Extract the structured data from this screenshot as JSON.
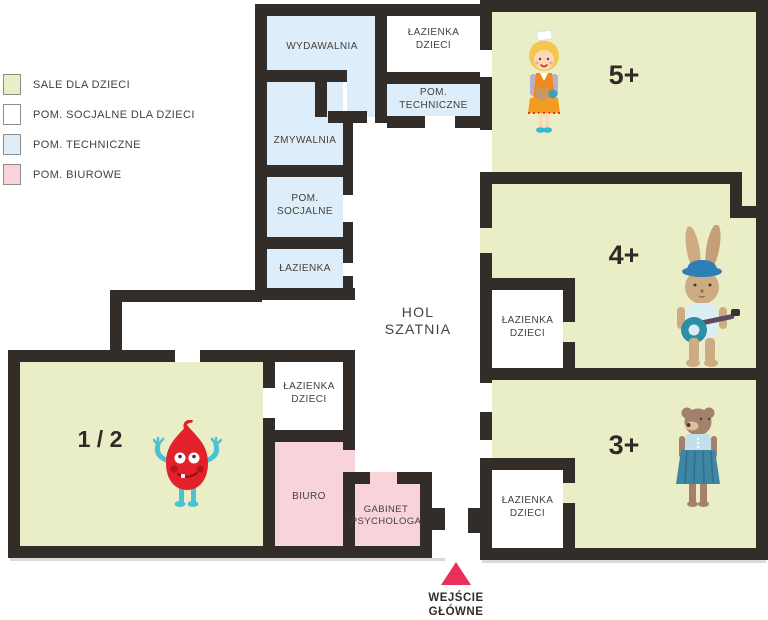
{
  "legend": {
    "items": [
      {
        "label": "SALE DLA DZIECI",
        "color": "#eaeec6"
      },
      {
        "label": "POM. SOCJALNE DLA DZIECI",
        "color": "#ffffff"
      },
      {
        "label": "POM. TECHNICZNE",
        "color": "#ddeefa"
      },
      {
        "label": "POM. BIUROWE",
        "color": "#f8d4da"
      }
    ]
  },
  "rooms": {
    "wydawalnia": {
      "label": "WYDAWALNIA",
      "type": "techniczne"
    },
    "lazienka_dzieci_top": {
      "line1": "ŁAZIENKA",
      "line2": "DZIECI",
      "type": "socjalne"
    },
    "pom_techniczne": {
      "line1": "POM.",
      "line2": "TECHNICZNE",
      "type": "techniczne"
    },
    "zmywalnia": {
      "label": "ZMYWALNIA",
      "type": "techniczne"
    },
    "pom_socjalne": {
      "line1": "POM.",
      "line2": "SOCJALNE",
      "type": "techniczne"
    },
    "lazienka": {
      "label": "ŁAZIENKA",
      "type": "techniczne"
    },
    "hol": {
      "line1": "HOL",
      "line2": "SZATNIA"
    },
    "sala_5": {
      "label": "5+",
      "type": "sala",
      "character": "girl-with-doll"
    },
    "sala_4": {
      "label": "4+",
      "type": "sala",
      "character": "rabbit-with-banjo"
    },
    "sala_3": {
      "label": "3+",
      "type": "sala",
      "character": "bear-in-dress"
    },
    "sala_12": {
      "label": "1 / 2",
      "type": "sala",
      "character": "red-monster"
    },
    "lazienka_dzieci_4": {
      "line1": "ŁAZIENKA",
      "line2": "DZIECI",
      "type": "socjalne"
    },
    "lazienka_dzieci_3": {
      "line1": "ŁAZIENKA",
      "line2": "DZIECI",
      "type": "socjalne"
    },
    "lazienka_dzieci_12": {
      "line1": "ŁAZIENKA",
      "line2": "DZIECI",
      "type": "socjalne"
    },
    "biuro": {
      "label": "BIURO",
      "type": "biurowe"
    },
    "gabinet_psychologa": {
      "line1": "GABINET",
      "line2": "PSYCHOLOGA",
      "type": "biurowe"
    }
  },
  "entrance": {
    "line1": "WEJŚCIE",
    "line2": "GŁÓWNE",
    "marker_color": "#e8305b"
  },
  "colors": {
    "wall": "#332d2a",
    "sale_dla_dzieci": "#eaeec6",
    "pom_socjalne": "#ffffff",
    "pom_techniczne": "#ddeefa",
    "pom_biurowe": "#f8d4da",
    "entrance_marker": "#e8305b",
    "label_text": "#45403c"
  }
}
